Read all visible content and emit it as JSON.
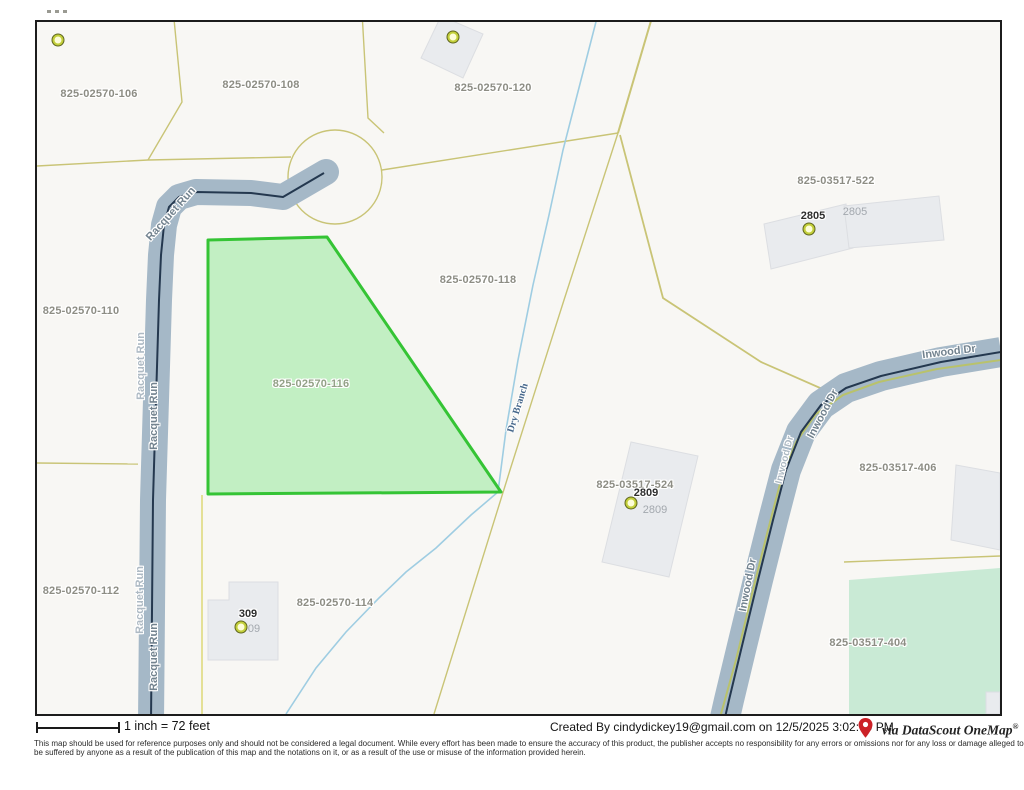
{
  "map": {
    "parcels": {
      "p106": "825-02570-106",
      "p108": "825-02570-108",
      "p120": "825-02570-120",
      "p522": "825-03517-522",
      "p118": "825-02570-118",
      "p110": "825-02570-110",
      "p116": "825-02570-116",
      "p524": "825-03517-524",
      "p406": "825-03517-406",
      "p112": "825-02570-112",
      "p114": "825-02570-114",
      "p404": "825-03517-404"
    },
    "roads": {
      "racquet": "Racquet Run",
      "inwood": "Inwood Dr"
    },
    "stream": {
      "name": "Dry Branch"
    },
    "houses": {
      "h2805_bold": "2805",
      "h2805_gray": "2805",
      "h2809_bold": "2809",
      "h2809_gray": "2809",
      "h309_bold": "309",
      "h309_gray": "09"
    },
    "selected_parcel": "825-02570-116",
    "colors": {
      "selected_fill": "#b9edba",
      "selected_border": "#35c435",
      "greenspace_fill": "#c9ead5",
      "parcel_line": "#c9c476",
      "road_band": "#a5b8c7",
      "road_centerline": "#24384f",
      "stream_line": "#9fcde2",
      "building_fill": "#e9ebee"
    }
  },
  "footer": {
    "scale_text": "1 inch = 72 feet",
    "created_by": "Created By  cindydickey19@gmail.com on 12/5/2025 3:02:09 PM",
    "via_text": "via DataScout OneMap",
    "via_reg": "®",
    "disclaimer_line1": "This map should be used for reference purposes only and should not be considered a legal document. While every effort has been made to ensure the accuracy of this product, the publisher accepts no responsibility for any errors or omissions nor for any loss or damage alleged to",
    "disclaimer_line2": "be suffered by anyone as a result of the publication of this map and the notations on it, or as a result of the use or misuse of the information provided herein."
  }
}
